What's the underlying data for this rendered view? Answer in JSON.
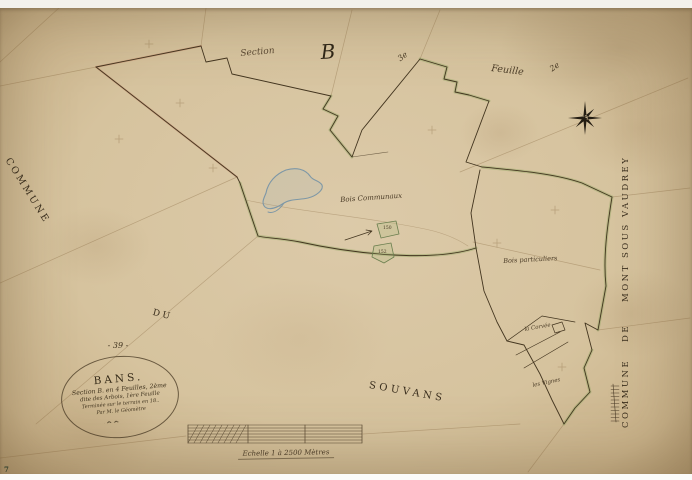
{
  "header": {
    "section_script": "Section",
    "section_letter": "B",
    "sheet_left": "3e",
    "feuille": "Feuille",
    "sheet_right": "2e"
  },
  "edges": {
    "left_commune": "COMMUNE",
    "du": "DU",
    "souvans": "SOUVANS",
    "right_commune": "COMMUNE",
    "right_de": "DE",
    "right_name": "MONT SOUS VAUDREY"
  },
  "cartouche": {
    "number": "- 39 -",
    "title": "BANS.",
    "line1": "Section B. en 4 Feuilles, 2ème",
    "line2": "dite des Arbois, 1ère Feuille",
    "line3": "Terminée sur le terrain en 18..",
    "line4": "Par M. le Géomètre"
  },
  "labels": {
    "bois_communaux": "Bois Communaux",
    "bois_particuliers": "Bois particuliers",
    "wedge_label_1": "la Corvée",
    "wedge_label_2": "les Vignes",
    "parcel_a": "150",
    "parcel_b": "152",
    "folio": "7"
  },
  "scale": {
    "caption": "Echelle 1 à 2500 Mètres"
  },
  "icons": {
    "compass": "compass-rose-star"
  },
  "colors": {
    "ink": "#43351f",
    "boundary_green": "#8fae6e",
    "boundary_red": "#c07a5e",
    "water_blue": "#7d97a6",
    "paper": "#d6c39e"
  }
}
